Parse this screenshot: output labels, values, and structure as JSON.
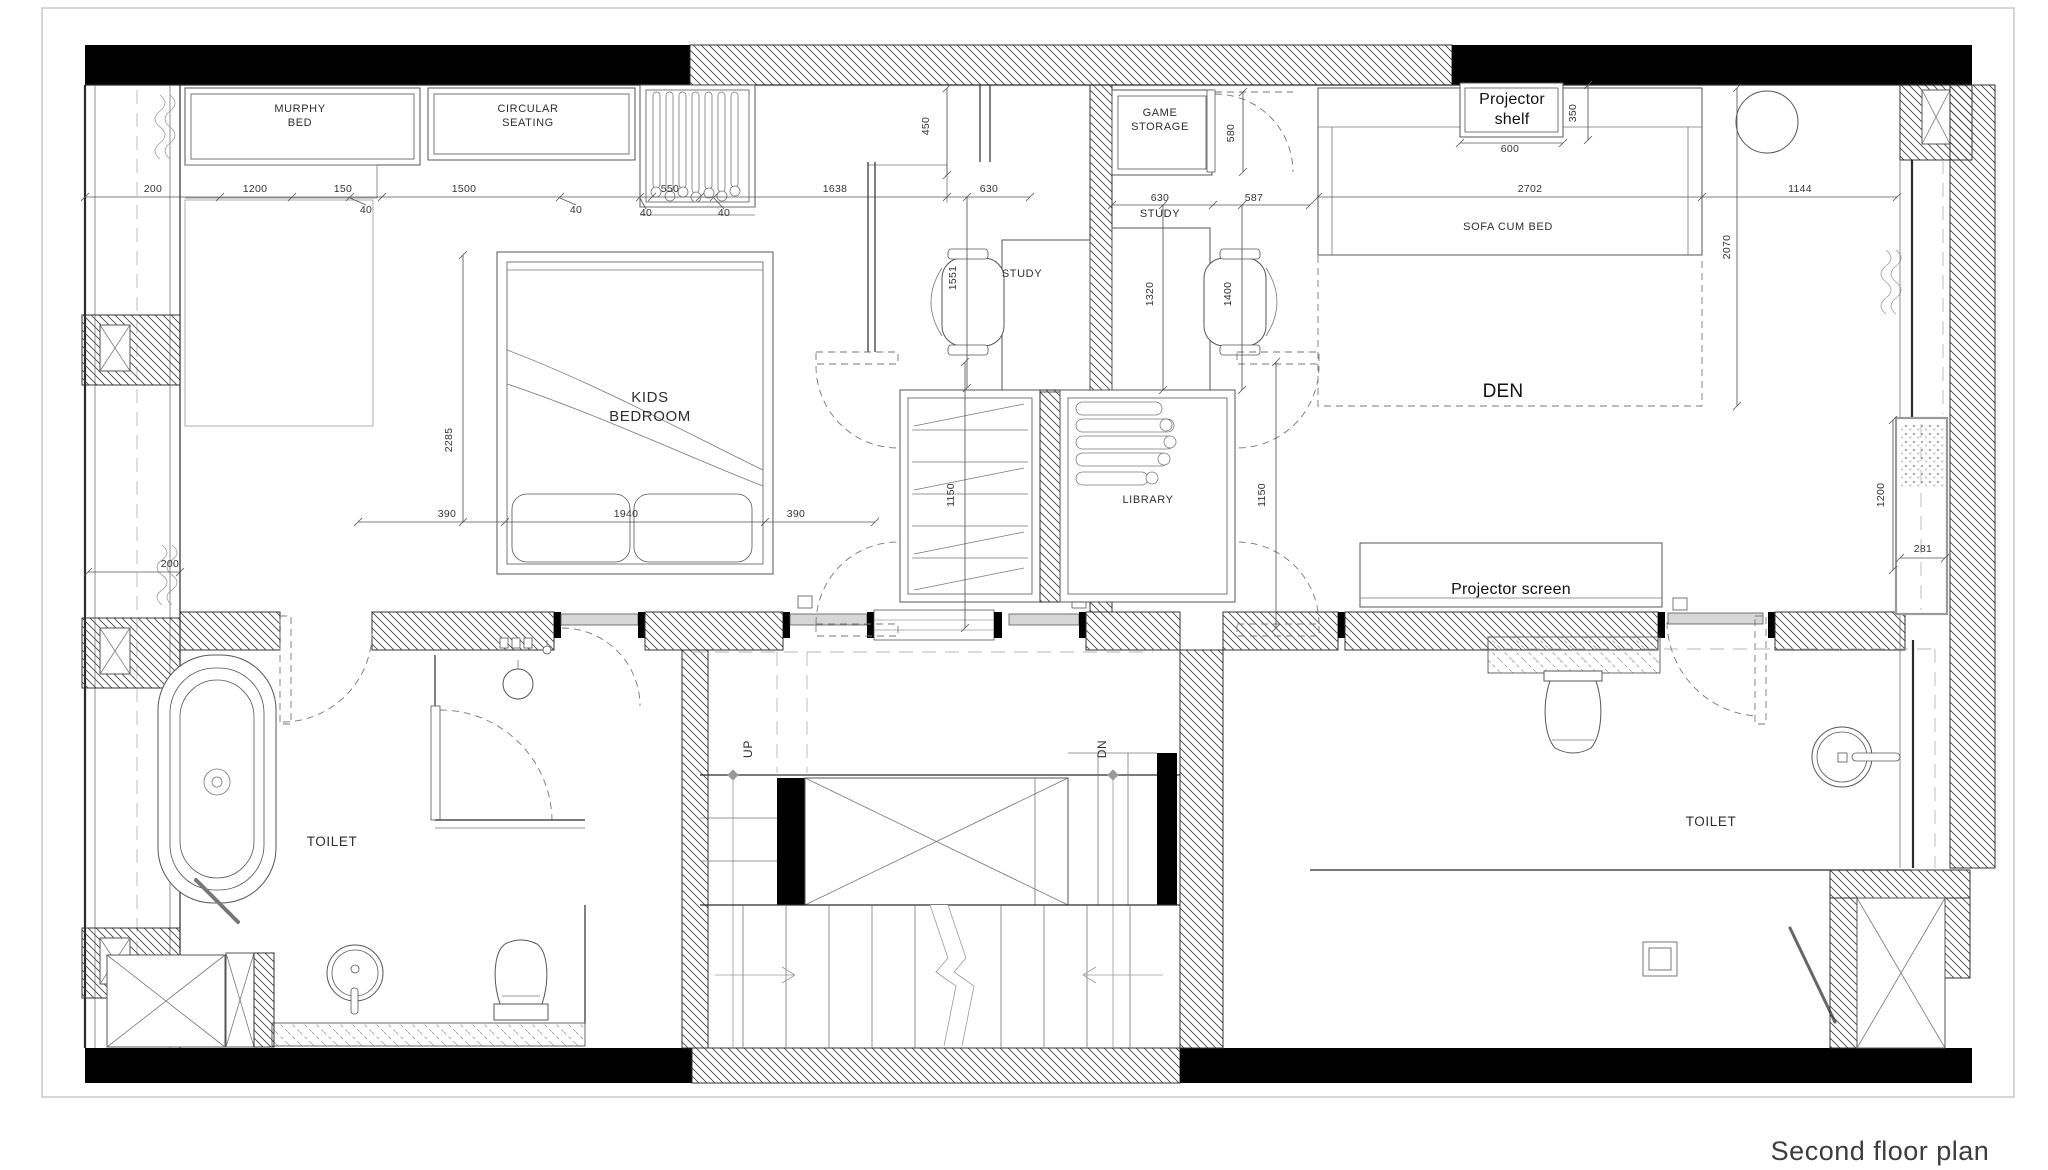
{
  "drawing": {
    "title": "Second floor plan",
    "type": "architectural floor plan"
  },
  "labels": [
    {
      "name": "label-murphy-bed",
      "text": "MURPHY\nBED",
      "x": 300,
      "y": 112,
      "s": 11
    },
    {
      "name": "label-circular-seating",
      "text": "CIRCULAR\nSEATING",
      "x": 528,
      "y": 112,
      "s": 11
    },
    {
      "name": "label-game-storage",
      "text": "GAME\nSTORAGE",
      "x": 1160,
      "y": 116,
      "s": 11
    },
    {
      "name": "label-study-left",
      "text": "STUDY",
      "x": 1022,
      "y": 277,
      "s": 11
    },
    {
      "name": "label-study-right",
      "text": "STUDY",
      "x": 1160,
      "y": 217,
      "s": 11
    },
    {
      "name": "label-projector-shelf",
      "text": "Projector\nshelf",
      "x": 1512,
      "y": 104,
      "s": 16,
      "cls": "annot"
    },
    {
      "name": "label-sofa-cum-bed",
      "text": "SOFA CUM BED",
      "x": 1508,
      "y": 230,
      "s": 11
    },
    {
      "name": "label-den",
      "text": "DEN",
      "x": 1503,
      "y": 397,
      "s": 19,
      "cls": "annot"
    },
    {
      "name": "label-kids-bedroom",
      "text": "KIDS\nBEDROOM",
      "x": 650,
      "y": 402,
      "s": 15
    },
    {
      "name": "label-library",
      "text": "LIBRARY",
      "x": 1148,
      "y": 503,
      "s": 11
    },
    {
      "name": "label-projector-screen",
      "text": "Projector screen",
      "x": 1511,
      "y": 594,
      "s": 16,
      "cls": "annot"
    },
    {
      "name": "label-toilet-left",
      "text": "TOILET",
      "x": 332,
      "y": 846,
      "s": 13.5
    },
    {
      "name": "label-toilet-right",
      "text": "TOILET",
      "x": 1711,
      "y": 826,
      "s": 13.5
    },
    {
      "name": "label-stair-up",
      "text": "UP",
      "x": 752,
      "y": 749,
      "s": 12,
      "rot": -90
    },
    {
      "name": "label-stair-dn",
      "text": "DN",
      "x": 1106,
      "y": 749,
      "s": 12,
      "rot": -90
    },
    {
      "name": "drawing-title",
      "text": "Second floor plan",
      "x": 1880,
      "y": 1160,
      "s": 27,
      "cls": "title"
    }
  ],
  "dimensions": [
    {
      "v": "200",
      "x": 153,
      "y": 192
    },
    {
      "v": "1200",
      "x": 255,
      "y": 192
    },
    {
      "v": "150",
      "x": 343,
      "y": 192
    },
    {
      "v": "1500",
      "x": 464,
      "y": 192
    },
    {
      "v": "40",
      "x": 366,
      "y": 213
    },
    {
      "v": "40",
      "x": 576,
      "y": 213
    },
    {
      "v": "550",
      "x": 670,
      "y": 192
    },
    {
      "v": "40",
      "x": 646,
      "y": 216
    },
    {
      "v": "40",
      "x": 724,
      "y": 216
    },
    {
      "v": "1638",
      "x": 835,
      "y": 192
    },
    {
      "v": "630",
      "x": 989,
      "y": 192
    },
    {
      "v": "630",
      "x": 1160,
      "y": 201
    },
    {
      "v": "587",
      "x": 1254,
      "y": 201
    },
    {
      "v": "2702",
      "x": 1530,
      "y": 192
    },
    {
      "v": "1144",
      "x": 1800,
      "y": 192
    },
    {
      "v": "600",
      "x": 1510,
      "y": 152
    },
    {
      "v": "450",
      "x": 929,
      "y": 126,
      "rot": -90
    },
    {
      "v": "580",
      "x": 1234,
      "y": 133,
      "rot": -90
    },
    {
      "v": "350",
      "x": 1576,
      "y": 113,
      "rot": -90
    },
    {
      "v": "2070",
      "x": 1730,
      "y": 247,
      "rot": -90
    },
    {
      "v": "1551",
      "x": 956,
      "y": 278,
      "rot": -90
    },
    {
      "v": "1320",
      "x": 1153,
      "y": 294,
      "rot": -90
    },
    {
      "v": "1400",
      "x": 1231,
      "y": 294,
      "rot": -90
    },
    {
      "v": "1150",
      "x": 954,
      "y": 495,
      "rot": -90
    },
    {
      "v": "1150",
      "x": 1265,
      "y": 495,
      "rot": -90
    },
    {
      "v": "2285",
      "x": 452,
      "y": 440,
      "rot": -90
    },
    {
      "v": "390",
      "x": 447,
      "y": 517
    },
    {
      "v": "1940",
      "x": 626,
      "y": 517
    },
    {
      "v": "390",
      "x": 796,
      "y": 517
    },
    {
      "v": "200",
      "x": 170,
      "y": 567
    },
    {
      "v": "1200",
      "x": 1884,
      "y": 495,
      "rot": -90
    },
    {
      "v": "281",
      "x": 1923,
      "y": 552
    }
  ]
}
